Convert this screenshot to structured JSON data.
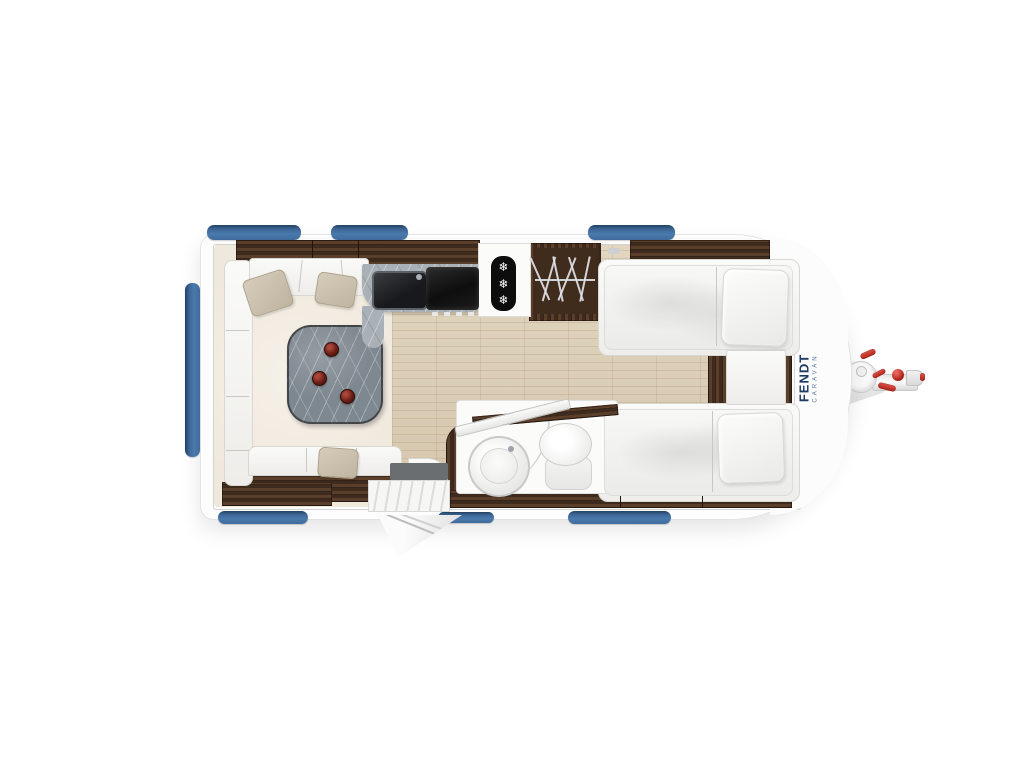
{
  "brand": {
    "name": "FENDT",
    "subtitle": "CARAVAN"
  },
  "fridge": {
    "snowflake": "❄"
  },
  "colors": {
    "window_blue": "#4a79ac",
    "brand_navy": "#1d3a63",
    "hitch_red": "#c6382c",
    "dark_wood": "#4b3627",
    "floor_wood": "#dccfb8",
    "lounge_floor": "#efe8dc",
    "marble_table": "#7e8890",
    "body_white": "#fdfdfd"
  }
}
